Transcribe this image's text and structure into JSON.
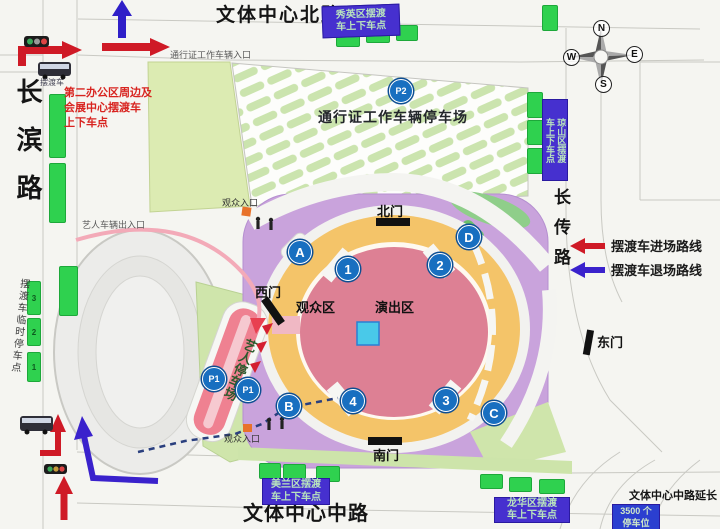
{
  "roads": {
    "north": "文体中心北路",
    "west": "长滨路",
    "east": "长传路",
    "south": "文体中心中路",
    "south_extension": "文体中心中路延长线"
  },
  "compass": {
    "n": "N",
    "e": "E",
    "s": "S",
    "w": "W"
  },
  "legend": {
    "enter_label": "摆渡车进场路线",
    "exit_label": "摆渡车退场路线",
    "enter_color": "#cf1a26",
    "exit_color": "#3a22cc"
  },
  "gates": {
    "north": "北门",
    "west": "西门",
    "east": "东门",
    "south": "南门"
  },
  "areas": {
    "audience": "观众区",
    "stage": "演出区",
    "permit_parking_lot": "通行证工作车辆停车场",
    "artist_parking": "艺人停车场"
  },
  "entrances": {
    "permit_vehicle": "通行证工作车辆入口",
    "artist_vehicle": "艺人车辆出入口",
    "audience_north": "观众入口",
    "audience_south": "观众入口"
  },
  "notes": {
    "office_shuttle_stop": "第二办公区周边及\n会展中心摆渡车\n上下车点",
    "shuttle_bus": "摆渡车",
    "temp_stop": "摆渡车临时停车点"
  },
  "badges": {
    "xiuying": "秀英区摆渡\n车上下车点",
    "qiongshan": "琼山区摆渡\n车上下车点",
    "meilan": "美兰区摆渡\n车上下车点",
    "longhua": "龙华区摆渡\n车上下车点",
    "parking_capacity": "3500 个\n停车位"
  },
  "markers": {
    "a": "A",
    "b": "B",
    "c": "C",
    "d": "D",
    "n1": "1",
    "n2": "2",
    "n3": "3",
    "n4": "4",
    "p1": "P1",
    "p2": "P2"
  },
  "stops": {
    "s1": "1",
    "s2": "2",
    "s3": "3"
  },
  "colors": {
    "marker_blue": "#186fc0",
    "badge_purple": "#4630cf",
    "stand_yellow": "#f4c469",
    "field_pink": "#dd8094",
    "stage_cyan": "#49c9e9",
    "stop_green": "#2fd14f"
  }
}
